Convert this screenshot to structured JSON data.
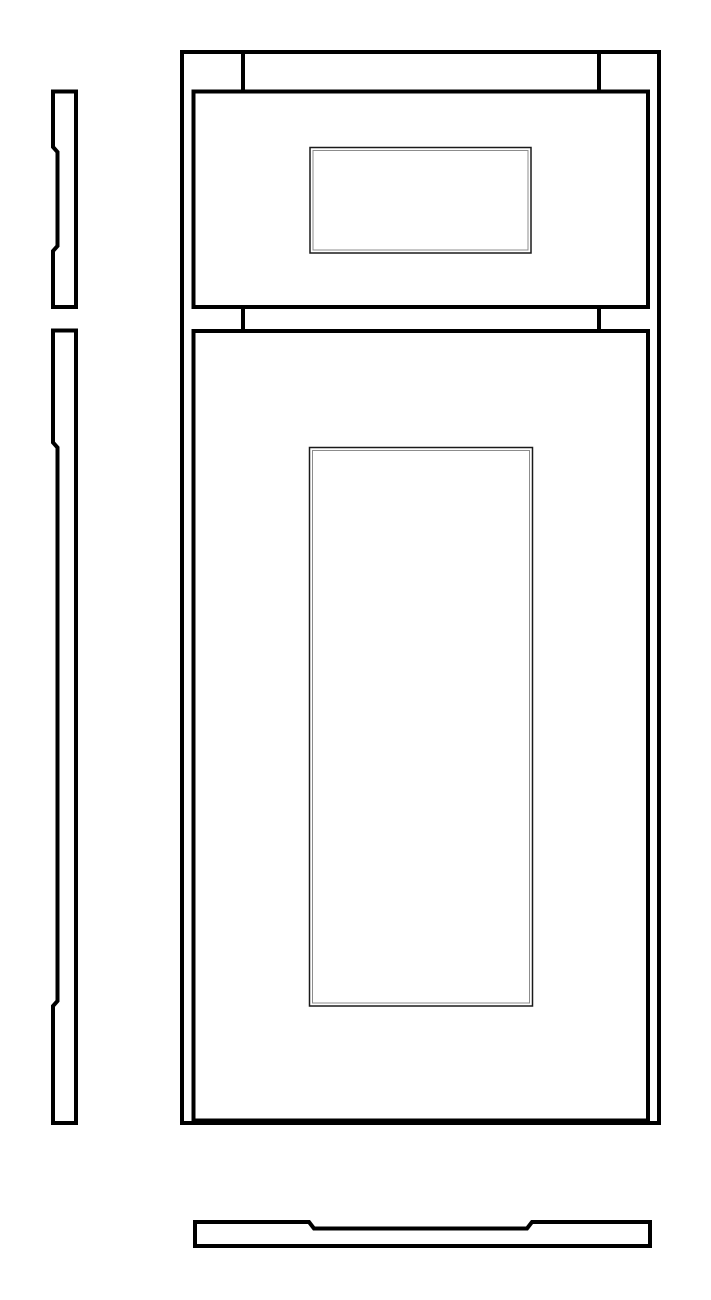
{
  "page": {
    "title": "cabinet-drawer-and-door-shop-drawing",
    "background": "#ffffff",
    "line_color": "#000000",
    "panel_outer_line_color": "#1a1a1a",
    "panel_inner_line_color": "#8c8c8c"
  },
  "drawing": {
    "canvas": {
      "width": 711,
      "height": 1300
    },
    "views": {
      "front_elevation": "cabinet face with drawer front over door",
      "left_top": "drawer front side section profile",
      "left_bottom": "door side section profile",
      "bottom": "door top section profile"
    },
    "shapes": [
      {
        "name": "cabinet-face-outline",
        "type": "rect",
        "x": 182,
        "y": 52,
        "w": 477,
        "h": 1071,
        "sw": 4,
        "stroke": "#000000"
      },
      {
        "name": "top-rail-joint-line-left",
        "type": "line",
        "x1": 243,
        "y1": 52,
        "x2": 243,
        "y2": 93,
        "sw": 4,
        "stroke": "#000000"
      },
      {
        "name": "top-rail-joint-line-right",
        "type": "line",
        "x1": 599,
        "y1": 52,
        "x2": 599,
        "y2": 93,
        "sw": 4,
        "stroke": "#000000"
      },
      {
        "name": "drawer-front-outline",
        "type": "rect",
        "x": 193.5,
        "y": 91.5,
        "w": 454.5,
        "h": 215.5,
        "sw": 4,
        "stroke": "#000000"
      },
      {
        "name": "drawer-recessed-panel-outer",
        "type": "rect",
        "x": 310,
        "y": 147.5,
        "w": 221,
        "h": 105.5,
        "sw": 1.5,
        "stroke": "#1a1a1a"
      },
      {
        "name": "drawer-recessed-panel-inner",
        "type": "rect",
        "x": 313,
        "y": 150.5,
        "w": 215,
        "h": 99.5,
        "sw": 1,
        "stroke": "#8c8c8c"
      },
      {
        "name": "mid-rail-joint-line-left",
        "type": "line",
        "x1": 243,
        "y1": 307,
        "x2": 243,
        "y2": 331,
        "sw": 4,
        "stroke": "#000000"
      },
      {
        "name": "mid-rail-joint-line-right",
        "type": "line",
        "x1": 599,
        "y1": 307,
        "x2": 599,
        "y2": 331,
        "sw": 4,
        "stroke": "#000000"
      },
      {
        "name": "door-outline",
        "type": "rect",
        "x": 193.5,
        "y": 331,
        "w": 454.5,
        "h": 789.5,
        "sw": 4,
        "stroke": "#000000"
      },
      {
        "name": "door-recessed-panel-outer",
        "type": "rect",
        "x": 309.5,
        "y": 447.5,
        "w": 223,
        "h": 558.5,
        "sw": 1.5,
        "stroke": "#1a1a1a"
      },
      {
        "name": "door-recessed-panel-inner",
        "type": "rect",
        "x": 312.5,
        "y": 450.5,
        "w": 217,
        "h": 552.5,
        "sw": 1,
        "stroke": "#8c8c8c"
      },
      {
        "name": "drawer-side-profile",
        "type": "polygon",
        "sw": 4,
        "stroke": "#000000",
        "points": [
          [
            53,
            91.5
          ],
          [
            76,
            91.5
          ],
          [
            76,
            307
          ],
          [
            53,
            307
          ],
          [
            53,
            251
          ],
          [
            57.5,
            246
          ],
          [
            57.5,
            152
          ],
          [
            53,
            147
          ]
        ]
      },
      {
        "name": "door-side-profile",
        "type": "polygon",
        "sw": 4,
        "stroke": "#000000",
        "points": [
          [
            53,
            330.5
          ],
          [
            76,
            330.5
          ],
          [
            76,
            1123
          ],
          [
            53,
            1123
          ],
          [
            53,
            1006
          ],
          [
            57.5,
            1001
          ],
          [
            57.5,
            447.5
          ],
          [
            53,
            442.5
          ]
        ]
      },
      {
        "name": "door-top-profile",
        "type": "polygon",
        "sw": 4,
        "stroke": "#000000",
        "points": [
          [
            195,
            1222
          ],
          [
            309,
            1222
          ],
          [
            314,
            1228.5
          ],
          [
            527,
            1228.5
          ],
          [
            532,
            1222
          ],
          [
            650,
            1222
          ],
          [
            650,
            1246
          ],
          [
            195,
            1246
          ]
        ]
      }
    ]
  }
}
